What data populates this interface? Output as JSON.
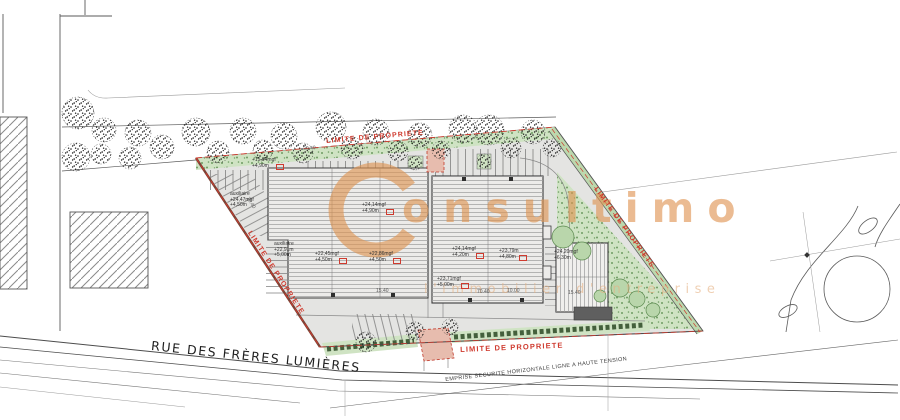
{
  "street": {
    "name": "RUE DES FRÈRES LUMIÈRES"
  },
  "boundary": {
    "label": "LIMITE DE PROPRIETE"
  },
  "notes": {
    "power_line": "EMPRISE SECURITE HORIZONTALE LIGNE A HAUTE TENSION"
  },
  "watermark": {
    "logo_letter": "C",
    "text": "onsultimo",
    "tagline": "l'immobilier d'entreprise",
    "color": "#df9350"
  },
  "levels": [
    {
      "lines": [
        "+15,94mgf",
        "+4,90m"
      ]
    },
    {
      "lines": [
        "auxiliaire",
        "+24,47mgf",
        "+4,50m"
      ]
    },
    {
      "lines": [
        "auxiliaire",
        "+22,91m",
        "+5,00m"
      ]
    },
    {
      "lines": [
        "+24,14mgf",
        "+4,90m"
      ]
    },
    {
      "lines": [
        "+22,45mgf",
        "+4,50m"
      ]
    },
    {
      "lines": [
        "+22,86mgf",
        "+4,50m"
      ]
    },
    {
      "lines": [
        "+24,14mgf",
        "+4,20m"
      ]
    },
    {
      "lines": [
        "+23,79m",
        "+4,80m"
      ]
    },
    {
      "lines": [
        "+23,71mgf",
        "+5,00m"
      ]
    },
    {
      "lines": [
        "+24,20mgf",
        "+6,30m"
      ]
    }
  ],
  "dimensions": [
    "30.40",
    "20.40",
    "15.40",
    "70.40",
    "15.40",
    "10.00"
  ],
  "colors": {
    "limite_red": "#cf3a2e",
    "green": "#cfe3c3",
    "watermark_orange": "#df9350"
  }
}
